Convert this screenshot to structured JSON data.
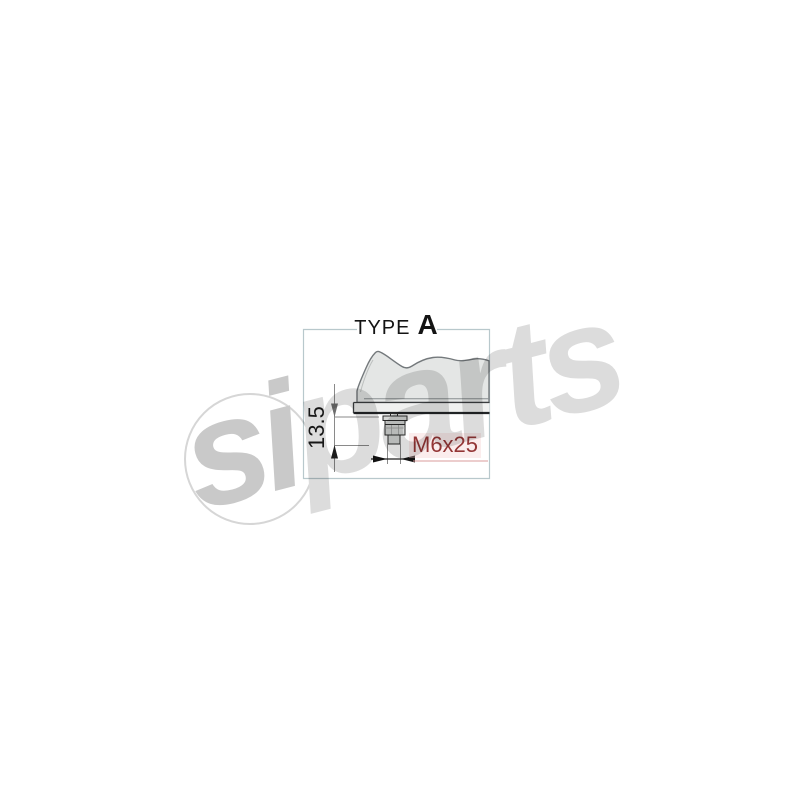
{
  "product_drawing": {
    "type_label_prefix": "TYPE",
    "type_variant": "A",
    "height_dimension_mm": "13.5",
    "bolt_spec": "M6x25"
  },
  "watermark": {
    "brand": "siparts",
    "segment_si": "si",
    "segment_parts": "parts"
  },
  "colors": {
    "bolt_spec_text": "#943636",
    "bolt_spec_underline": "#d89b9b",
    "frame_border": "#b8c8cc",
    "housing_fill": "#e4e6e5",
    "housing_outline": "#74797c",
    "plate_fill": "#f0f1f0",
    "stud_fill": "#d6d8d7",
    "dimension_line": "#8a8a8a",
    "watermark_gray": "#dcdcdc"
  }
}
